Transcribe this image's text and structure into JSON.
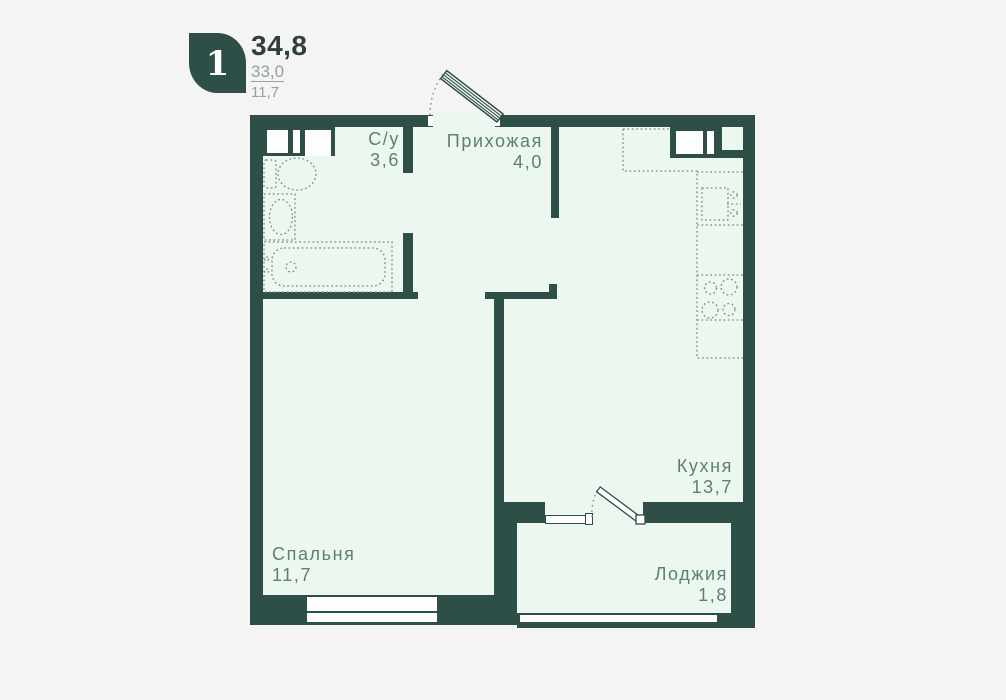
{
  "colors": {
    "wall": "#2d4f47",
    "interior": "#ecf7f0",
    "background": "#f4f4f3",
    "label": "#5e7e76",
    "muted": "#93a29c",
    "title": "#323e3a",
    "fixture": "#729088",
    "white": "#fdfdfd"
  },
  "header": {
    "rooms_count": "1",
    "total_area": "34,8",
    "living_area": "33,0",
    "rooms_area": "11,7"
  },
  "rooms": [
    {
      "id": "bathroom",
      "name": "С/у",
      "area": "3,6"
    },
    {
      "id": "hallway",
      "name": "Прихожая",
      "area": "4,0"
    },
    {
      "id": "kitchen",
      "name": "Кухня",
      "area": "13,7"
    },
    {
      "id": "bedroom",
      "name": "Спальня",
      "area": "11,7"
    },
    {
      "id": "loggia",
      "name": "Лоджия",
      "area": "1,8"
    }
  ],
  "symbols": [
    "entrance-door-swing",
    "balcony-door-swing",
    "toilet",
    "wash-basin",
    "bathtub",
    "kitchen-sink",
    "stove-4-burners",
    "kitchen-counter",
    "vent-shaft",
    "window"
  ]
}
